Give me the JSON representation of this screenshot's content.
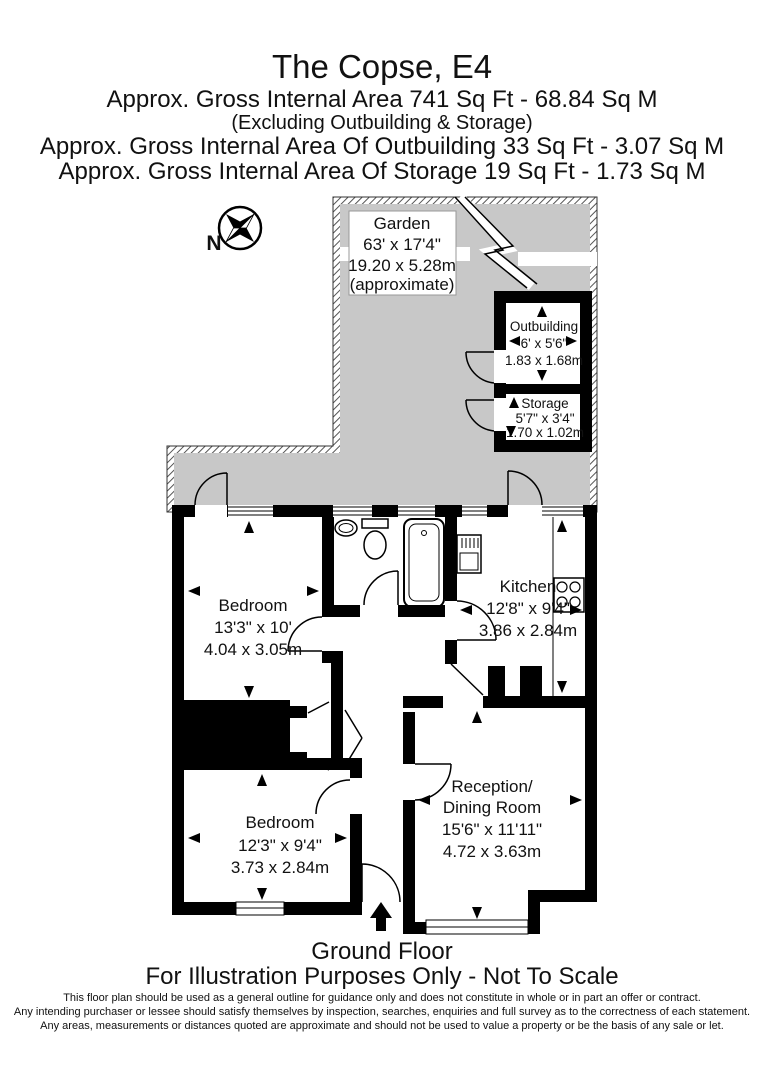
{
  "header": {
    "title": "The Copse, E4",
    "line1": "Approx. Gross Internal Area  741 Sq Ft  -  68.84 Sq M",
    "line2": "(Excluding Outbuilding & Storage)",
    "line3": "Approx. Gross Internal Area Of Outbuilding  33 Sq Ft  -  3.07 Sq M",
    "line4": "Approx. Gross Internal Area Of Storage  19 Sq Ft  -  1.73 Sq M"
  },
  "compass": {
    "north_label": "N"
  },
  "rooms": {
    "garden": {
      "name": "Garden",
      "dim_ft": "63' x 17'4\"",
      "dim_m": "19.20 x 5.28m",
      "note": "(approximate)"
    },
    "outbuilding": {
      "name": "Outbuilding",
      "dim_ft": "6' x 5'6\"",
      "dim_m": "1.83 x 1.68m"
    },
    "storage": {
      "name": "Storage",
      "dim_ft": "5'7\" x 3'4\"",
      "dim_m": "1.70 x 1.02m"
    },
    "kitchen": {
      "name": "Kitchen",
      "dim_ft": "12'8\" x 9'4\"",
      "dim_m": "3.86 x 2.84m"
    },
    "bedroom1": {
      "name": "Bedroom",
      "dim_ft": "13'3\" x 10'",
      "dim_m": "4.04 x 3.05m"
    },
    "bedroom2": {
      "name": "Bedroom",
      "dim_ft": "12'3\" x 9'4\"",
      "dim_m": "3.73 x 2.84m"
    },
    "reception": {
      "name": "Reception/",
      "name2": "Dining Room",
      "dim_ft": "15'6\" x 11'11\"",
      "dim_m": "4.72 x 3.63m"
    }
  },
  "footer": {
    "floor": "Ground Floor",
    "note": "For Illustration Purposes Only - Not To Scale",
    "disclaimer1": "This floor plan should be used as a general outline for guidance only and does not constitute in whole or in part an offer or contract.",
    "disclaimer2": "Any intending purchaser or lessee should satisfy themselves by inspection, searches, enquiries and full survey as to the correctness of each statement.",
    "disclaimer3": "Any areas, measurements or distances quoted are approximate and should not be used to value a property or be the basis of any sale or let."
  },
  "colors": {
    "wall": "#000000",
    "garden_fill": "#c8c8c8",
    "background": "#ffffff",
    "text": "#111111"
  }
}
